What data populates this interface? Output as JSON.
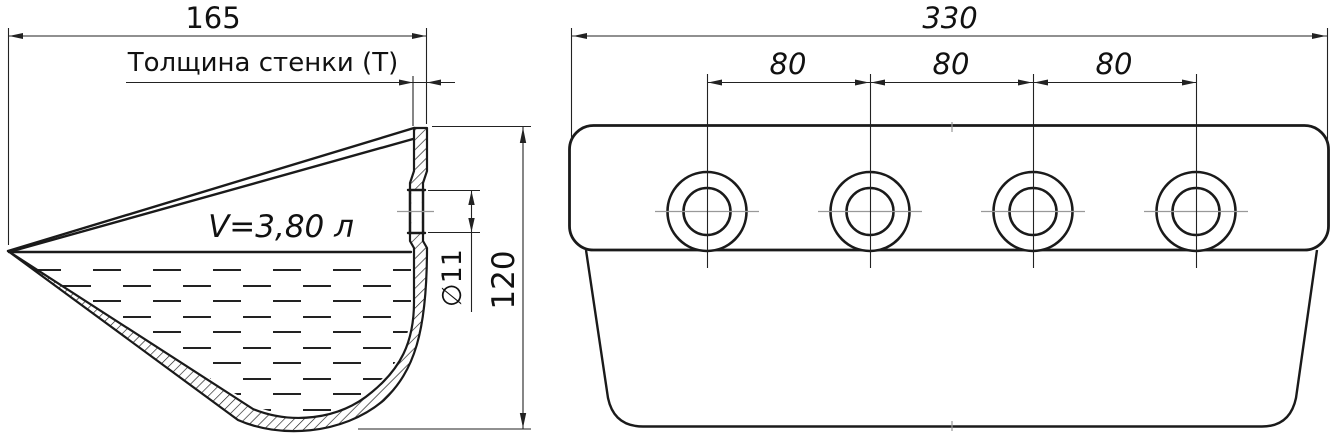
{
  "drawing": {
    "left_view": {
      "width_dim": "165",
      "wall_thickness_label": "Толщина стенки (Т)",
      "volume_label": "V=3,80 л",
      "hole_diameter_dim": "∅11",
      "height_dim": "120"
    },
    "right_view": {
      "width_dim": "330",
      "hole_spacing_dims": [
        "80",
        "80",
        "80"
      ]
    },
    "colors": {
      "line": "#1a1a1a",
      "dimension_line": "#222222",
      "centerline": "#999999",
      "background": "#ffffff"
    }
  }
}
